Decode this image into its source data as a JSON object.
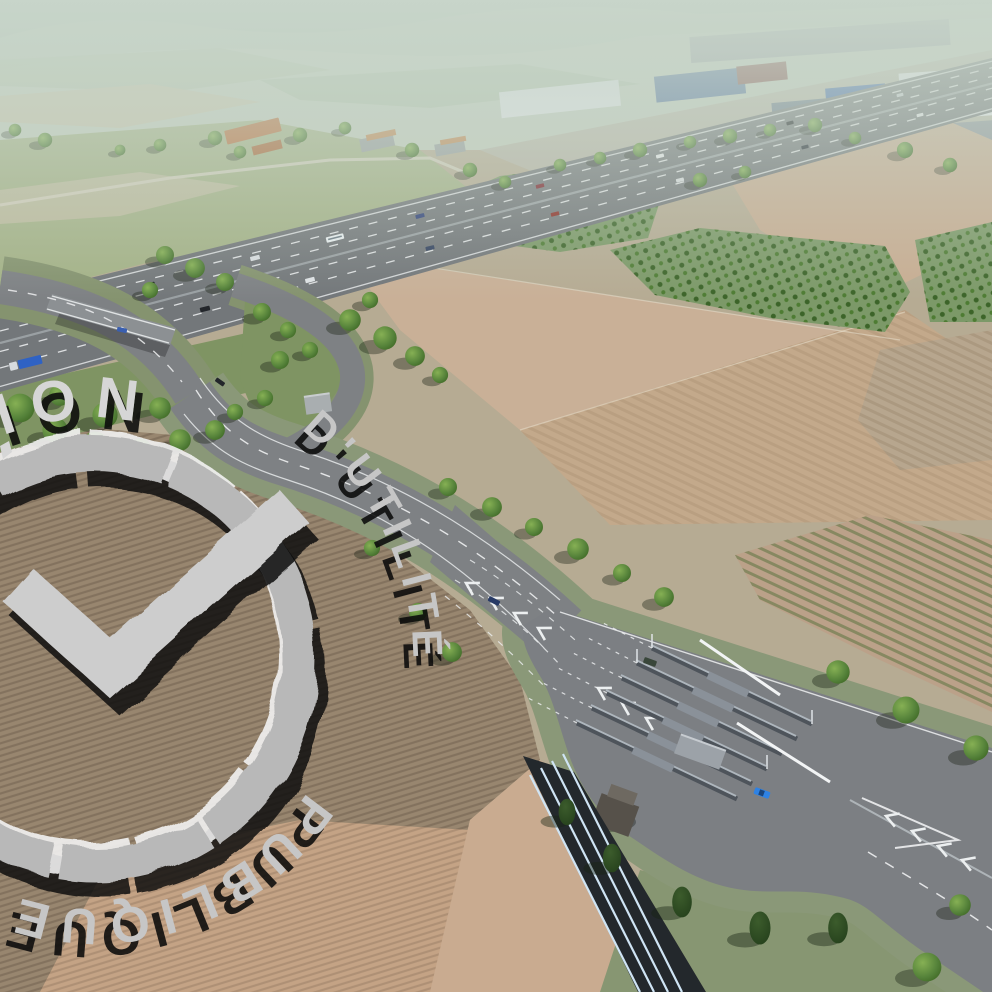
{
  "watermark": {
    "top_text": "ION",
    "middle_text": "D'UTILITÉ",
    "bottom_text": "PUBLIQUE",
    "stamp_color": "#cdcdcd",
    "shadow_color": "#0b0b0b"
  },
  "scene": {
    "type": "aerial-3d-render",
    "subject": "planned motorway interchange with toll plaza surrounded by farmland and industrial zone",
    "palette": {
      "haze": "#c9d6cb",
      "field_tan": "#c5ad92",
      "field_plowed": "#98866f",
      "field_pink": "#c6a78b",
      "grass_verge": "#8a9878",
      "orchard_green": "#4f7a35",
      "motorway_asphalt": "#73777a",
      "road_asphalt": "#7e8184",
      "toll_plaza_asphalt": "#7c7f83",
      "tree_green": "#4d7234",
      "conifer_green": "#2f4f25",
      "barrier_stripe_blue": "#cfe4f4",
      "car_blue": "#2e82e4",
      "truck_blue": "#2f62c4",
      "farm_roof_orange": "#b9703d",
      "warehouse_blue": "#4f6f9d",
      "warehouse_white": "#e9edf0"
    }
  }
}
